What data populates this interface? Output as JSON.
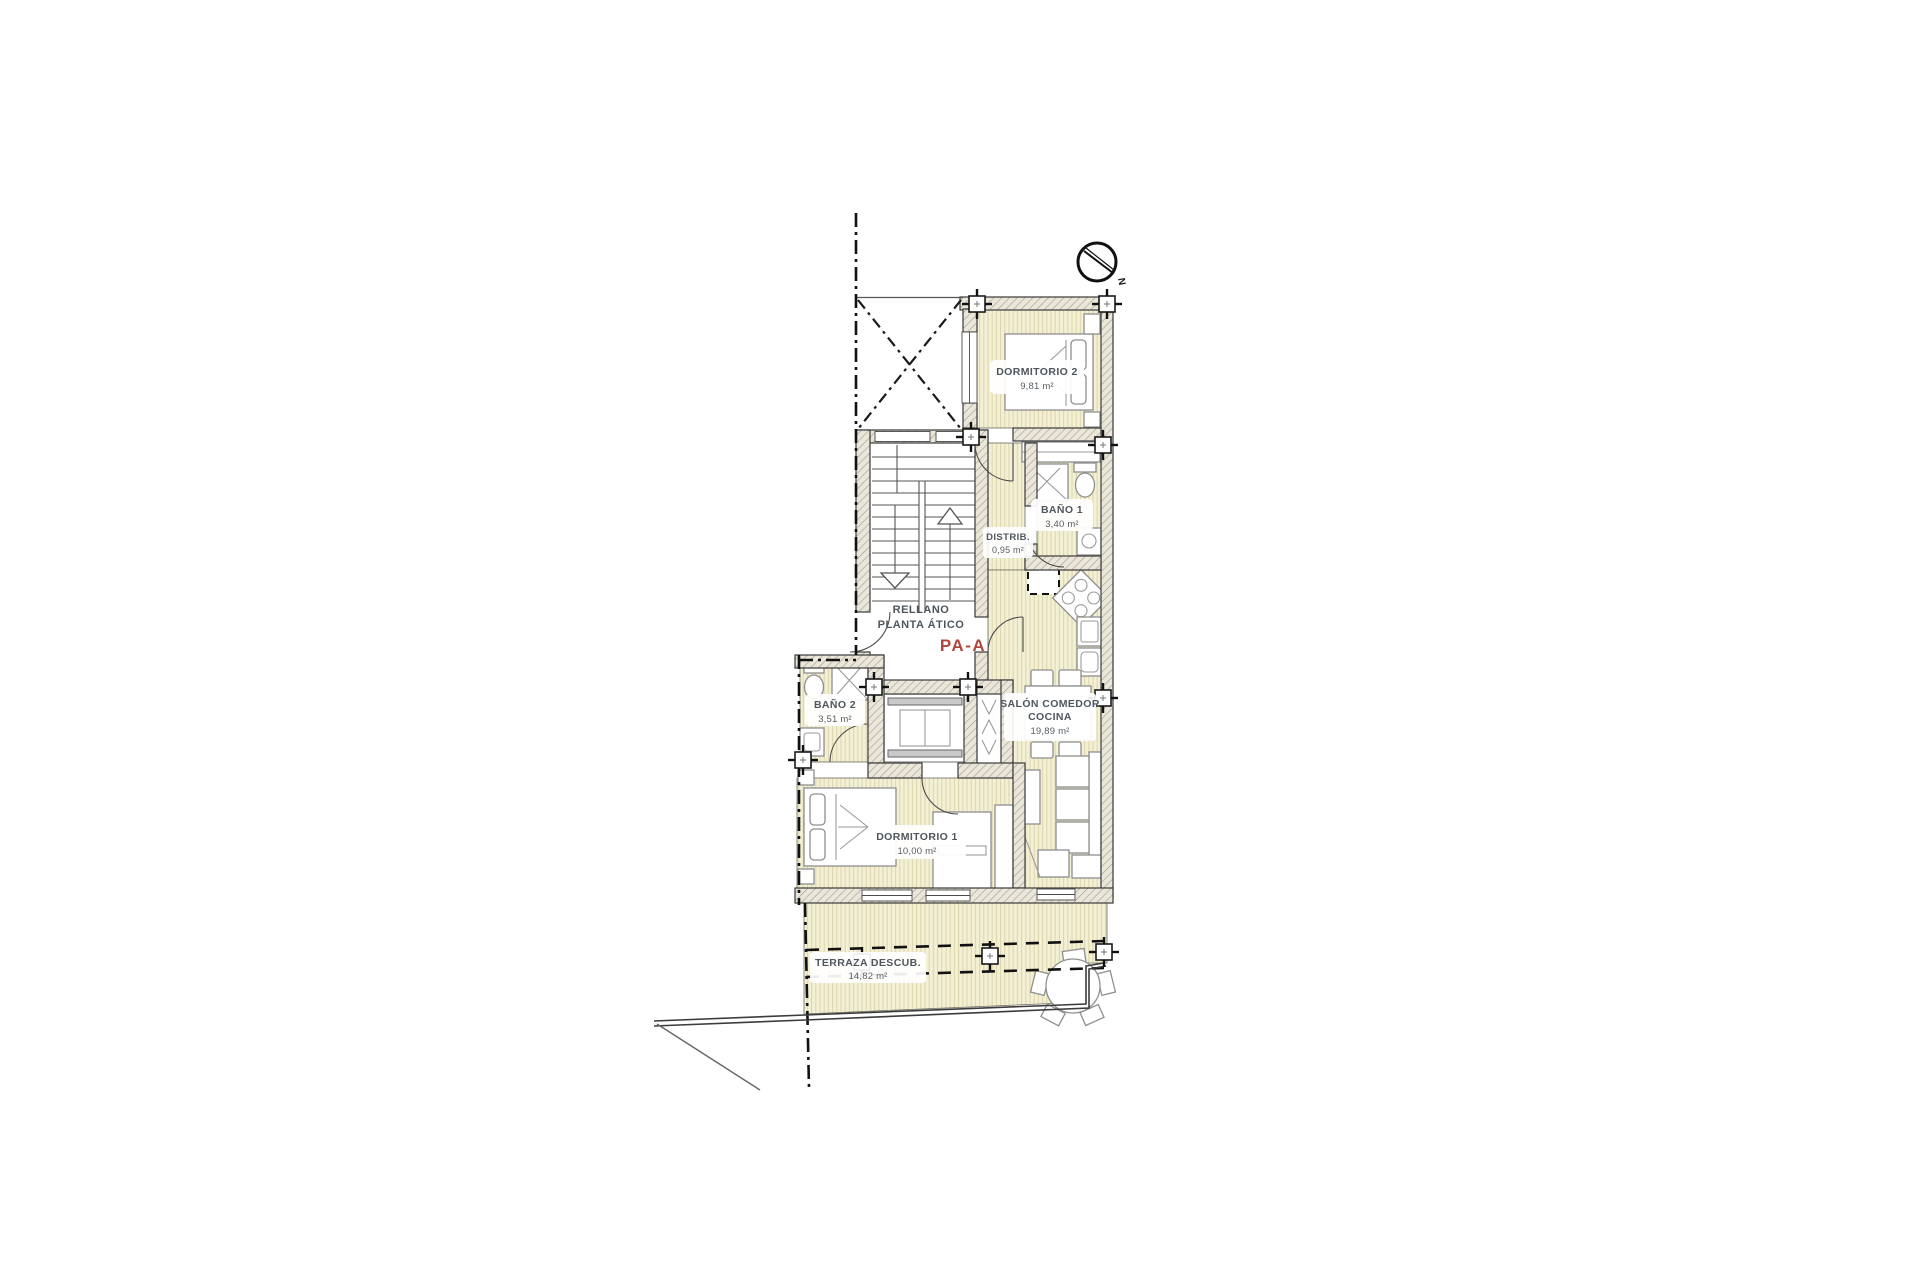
{
  "plan": {
    "rooms": {
      "dorm2": {
        "name": "DORMITORIO 2",
        "area": "9,81 m²"
      },
      "bano1": {
        "name": "BAÑO 1",
        "area": "3,40 m²"
      },
      "distrib": {
        "name": "DISTRIB.",
        "area": "0,95 m²"
      },
      "landing": {
        "line1": "RELLANO",
        "line2": "PLANTA ÁTICO",
        "code": "PA-A"
      },
      "bano2": {
        "name": "BAÑO 2",
        "area": "3,51 m²"
      },
      "salon": {
        "line1": "SALÓN COMEDOR",
        "line2": "COCINA",
        "area": "19,89 m²"
      },
      "dorm1": {
        "name": "DORMITORIO 1",
        "area": "10,00 m²"
      },
      "terrace": {
        "name": "TERRAZA DESCUB.",
        "area": "14,82 m²"
      }
    },
    "compass": {
      "label": "N"
    },
    "colors": {
      "floor": "#f4f0d5",
      "floor_stripe": "#ddd7ae",
      "wall_fill": "#eae6d9",
      "wall_hatch": "#a49d8f",
      "outline": "#3a3a3a",
      "accent_red": "#b0483e",
      "label_text": "#4e565e"
    }
  }
}
